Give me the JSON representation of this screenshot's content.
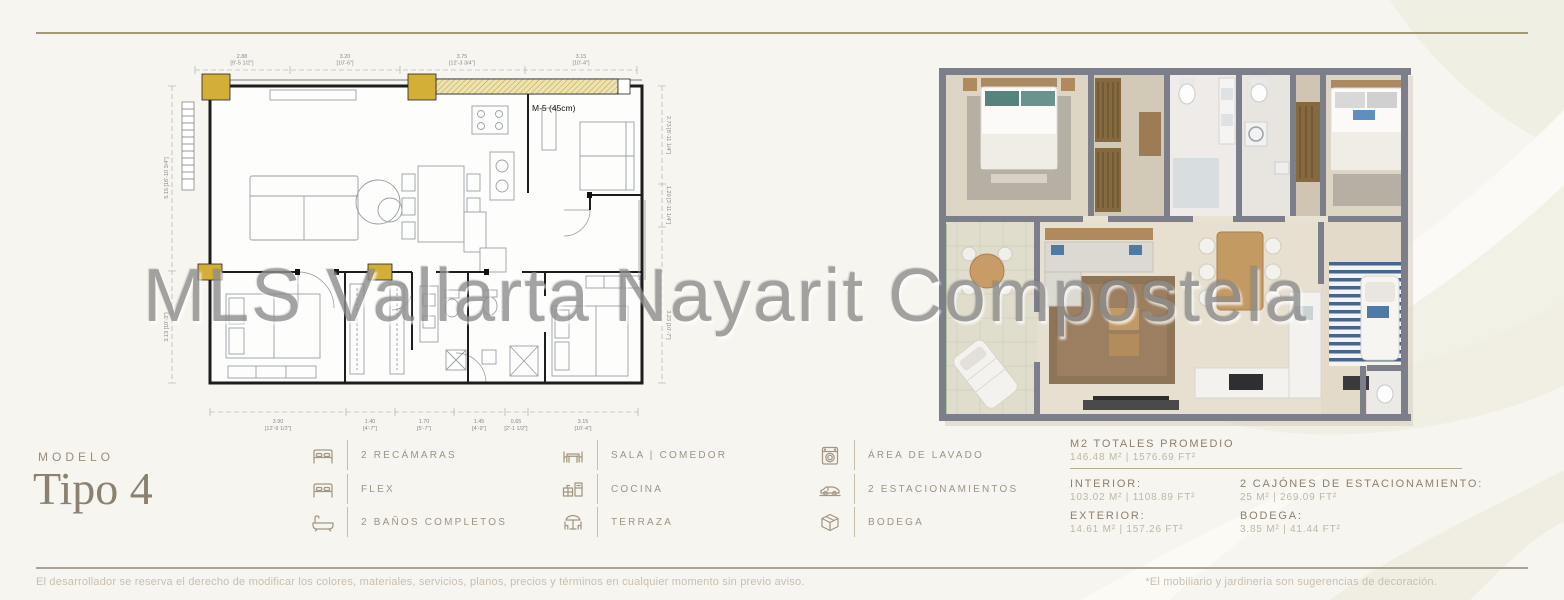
{
  "page": {
    "watermark": "MLS Vallarta Nayarit Compostela",
    "model_label": "MODELO",
    "model_name": "Tipo 4"
  },
  "floorplan": {
    "wall_note": "M-5 (45cm)",
    "dims_top": [
      {
        "m": "2.88",
        "ft": "[9'-5 1/2\"]"
      },
      {
        "m": "3.20",
        "ft": "[10'-6\"]"
      },
      {
        "m": "3.75",
        "ft": "[12'-3 3/4\"]"
      },
      {
        "m": "3.15",
        "ft": "[10'-4\"]"
      }
    ],
    "dims_bottom": [
      {
        "m": "3.90",
        "ft": "[12'-9 1/2\"]"
      },
      {
        "m": "1.40",
        "ft": "[4'-7\"]"
      },
      {
        "m": "1.70",
        "ft": "[5'-7\"]"
      },
      {
        "m": "1.45",
        "ft": "[4'-9\"]"
      },
      {
        "m": "0.65",
        "ft": "[2'-1 1/2\"]"
      },
      {
        "m": "3.15",
        "ft": "[10'-4\"]"
      }
    ],
    "dims_left": [
      "5.15 [16'-10 3/4\"]",
      "3.13 [10'-3\"]"
    ],
    "dims_right": [
      "2.73 [8'-11 1/4\"]",
      "1.20 [3'-11 1/4\"]",
      "3.23 [10'-7\"]"
    ]
  },
  "amenities": [
    {
      "icon": "bed-icon",
      "label": "2 RECÁMARAS"
    },
    {
      "icon": "flex-bed-icon",
      "label": "FLEX"
    },
    {
      "icon": "bathtub-icon",
      "label": "2 BAÑOS COMPLETOS"
    },
    {
      "icon": "dining-table-icon",
      "label": "SALA | COMEDOR"
    },
    {
      "icon": "kitchen-icon",
      "label": "COCINA"
    },
    {
      "icon": "terrace-icon",
      "label": "TERRAZA"
    },
    {
      "icon": "washing-machine-icon",
      "label": "ÁREA DE LAVADO"
    },
    {
      "icon": "car-icon",
      "label": "2 ESTACIONAMIENTOS"
    },
    {
      "icon": "storage-box-icon",
      "label": "BODEGA"
    }
  ],
  "stats": {
    "total_label": "M2 TOTALES PROMEDIO",
    "total_value": "146.48 M² | 1576.69 FT²",
    "interior_label": "INTERIOR:",
    "interior_value": "103.02 M² | 1108.89 FT²",
    "exterior_label": "EXTERIOR:",
    "exterior_value": "14.61 M² | 157.26 FT²",
    "parking_label": "2 CAJÓNES DE ESTACIONAMIENTO:",
    "parking_value": "25 M² | 269.09 FT²",
    "storage_label": "BODEGA:",
    "storage_value": "3.85 M² | 41.44 FT²"
  },
  "footer": {
    "left": "El desarrollador se reserva el derecho de modificar los colores, materiales, servicios, planos, precios y términos en cualquier momento sin previo aviso.",
    "right": "*El mobiliario y jardinería son sugerencias de decoración."
  },
  "colors": {
    "accent_gold_line": "#a59873",
    "column_gold": "#d4af37",
    "render_wall_gray": "#7c7f89",
    "text_taupe": "#9f9483"
  }
}
